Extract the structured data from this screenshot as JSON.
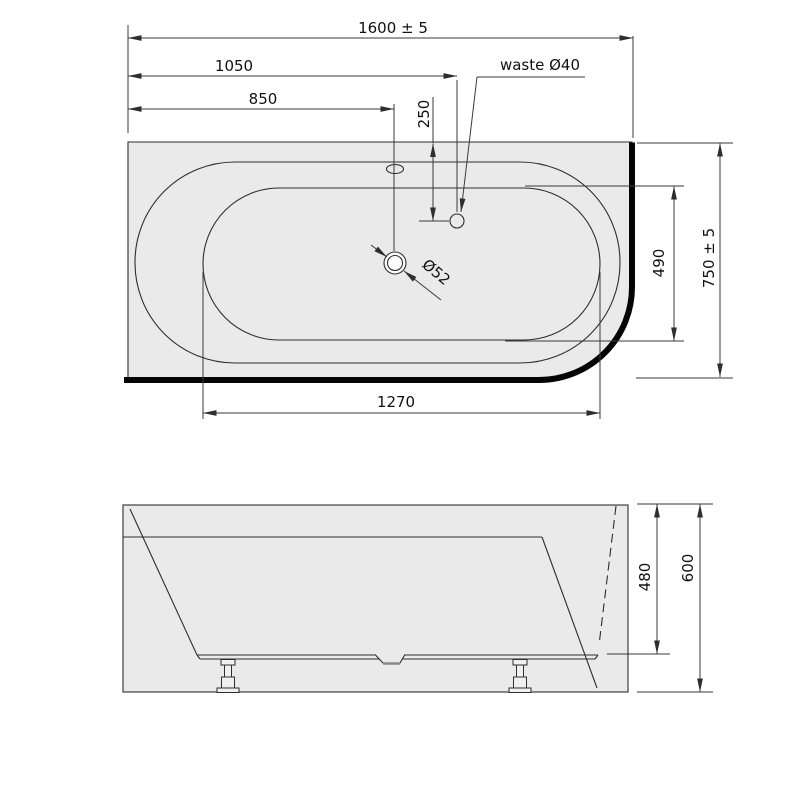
{
  "drawing": {
    "kind": "bathtub technical dimension drawing",
    "views": [
      "top view",
      "front view"
    ]
  },
  "colors": {
    "background": "#ffffff",
    "surface_fill": "#eaeaea",
    "outline": "#2e2e2e",
    "wall_edge": "#050505",
    "dimension_line": "#3a3a3a",
    "text": "#111111"
  },
  "top_view": {
    "labels": {
      "overall_length": "1600 ± 5",
      "waste_offset_x": "1050",
      "drain_offset_x": "850",
      "waste_offset_y": "250",
      "waste_note": "waste Ø40",
      "drain_diameter": "Ø52",
      "inner_width": "490",
      "overall_width": "750 ± 5",
      "bottom_length": "1270"
    }
  },
  "front_view": {
    "labels": {
      "inner_depth": "480",
      "overall_height": "600"
    }
  }
}
